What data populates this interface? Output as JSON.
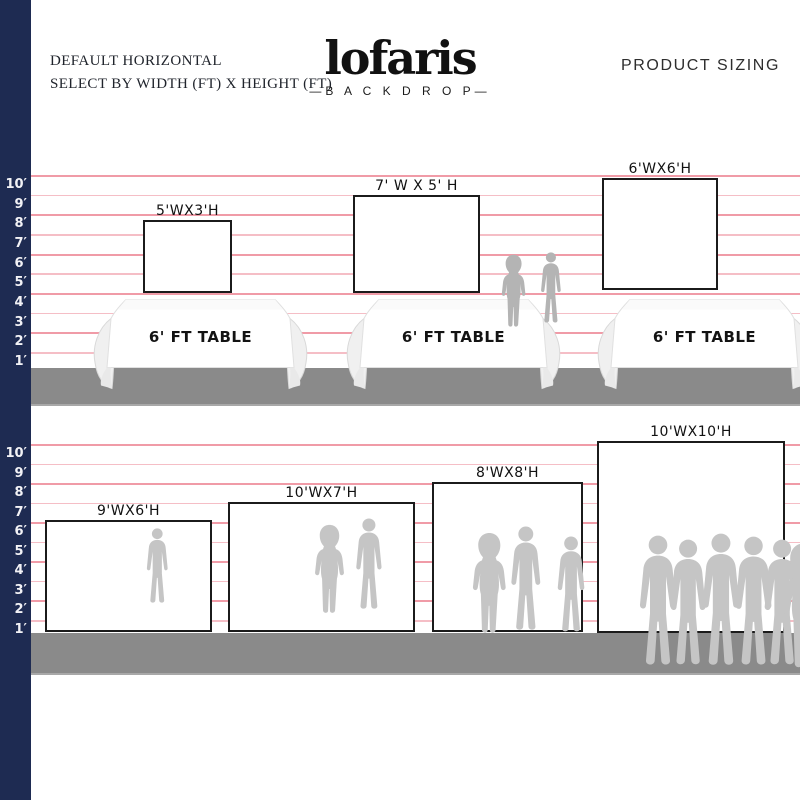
{
  "header": {
    "subtitle_line1": "DEFAULT HORIZONTAL",
    "subtitle_line2": "SELECT BY WIDTH (FT) X HEIGHT (FT)",
    "logo_text": "lofaris",
    "logo_tagline": "—B A C K D R O P—",
    "title_right": "PRODUCT SIZING"
  },
  "ruler": {
    "labels": [
      "10′",
      "9′",
      "8′",
      "7′",
      "6′",
      "5′",
      "4′",
      "3′",
      "2′",
      "1′"
    ]
  },
  "top_row": {
    "backdrops": [
      {
        "label": "5'WX3'H",
        "width_ft": 5,
        "height_ft": 3
      },
      {
        "label": "7' W X 5' H",
        "width_ft": 7,
        "height_ft": 5
      },
      {
        "label": "6'WX6'H",
        "width_ft": 6,
        "height_ft": 6
      }
    ],
    "tables": [
      {
        "label": "6' FT TABLE"
      },
      {
        "label": "6' FT TABLE"
      },
      {
        "label": "6' FT TABLE"
      }
    ]
  },
  "bottom_row": {
    "backdrops": [
      {
        "label": "9'WX6'H",
        "width_ft": 9,
        "height_ft": 6
      },
      {
        "label": "10'WX7'H",
        "width_ft": 10,
        "height_ft": 7
      },
      {
        "label": "8'WX8'H",
        "width_ft": 8,
        "height_ft": 8
      },
      {
        "label": "10'WX10'H",
        "width_ft": 10,
        "height_ft": 10
      }
    ]
  },
  "colors": {
    "navy_bar": "#1e2b52",
    "grid_pink": "#f09ba7",
    "floor_gray": "#8a8a8a",
    "silhouette_gray": "#c5c5c5",
    "backdrop_border": "#1b1b1b"
  }
}
